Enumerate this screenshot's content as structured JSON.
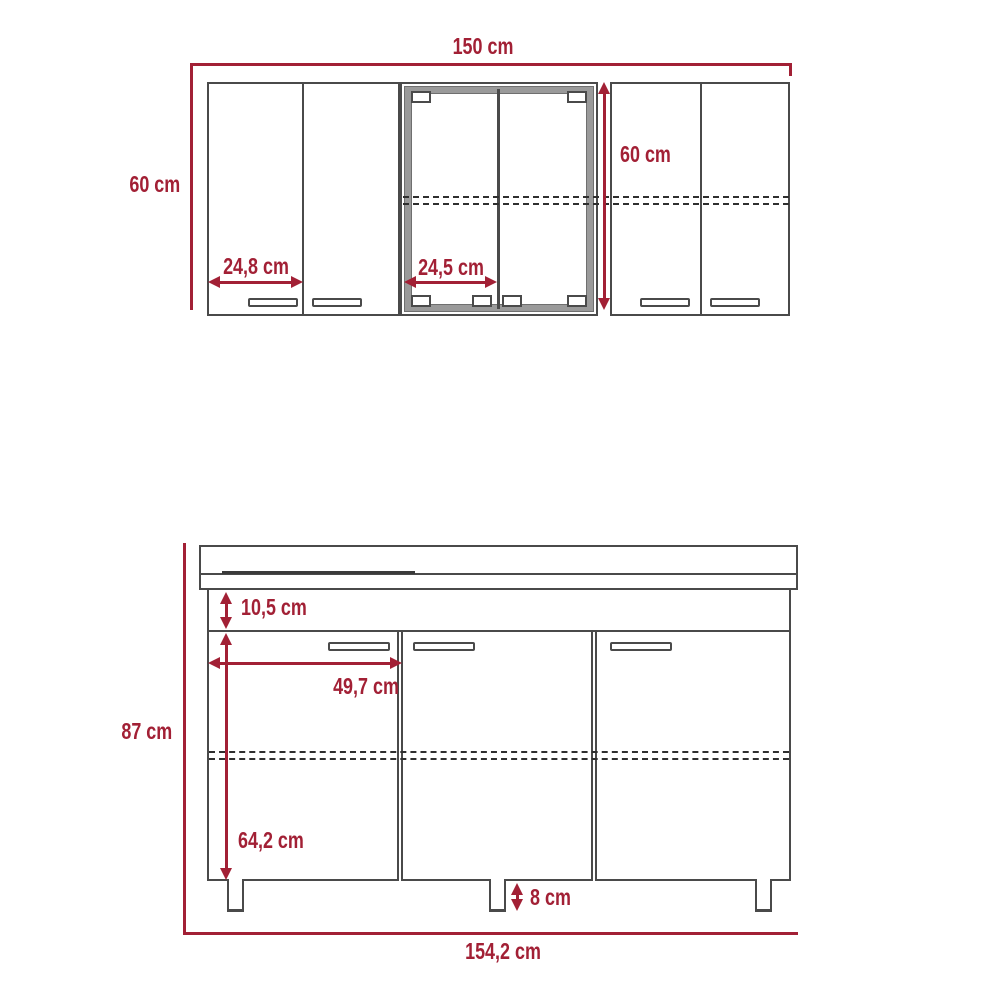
{
  "colors": {
    "dimension_red": "#a22035",
    "outline_gray": "#4a4a4a",
    "glass_frame_gray": "#9a9a9a",
    "background": "#ffffff"
  },
  "upper_unit": {
    "width": "150 cm",
    "height_left": "60 cm",
    "height_right": "60 cm",
    "left_door_width": "24,8 cm",
    "center_door_width": "24,5 cm"
  },
  "lower_unit": {
    "total_height": "87 cm",
    "top_rail_height": "10,5 cm",
    "door_width": "49,7 cm",
    "door_height": "64,2 cm",
    "leg_height": "8 cm",
    "total_width": "154,2 cm"
  }
}
